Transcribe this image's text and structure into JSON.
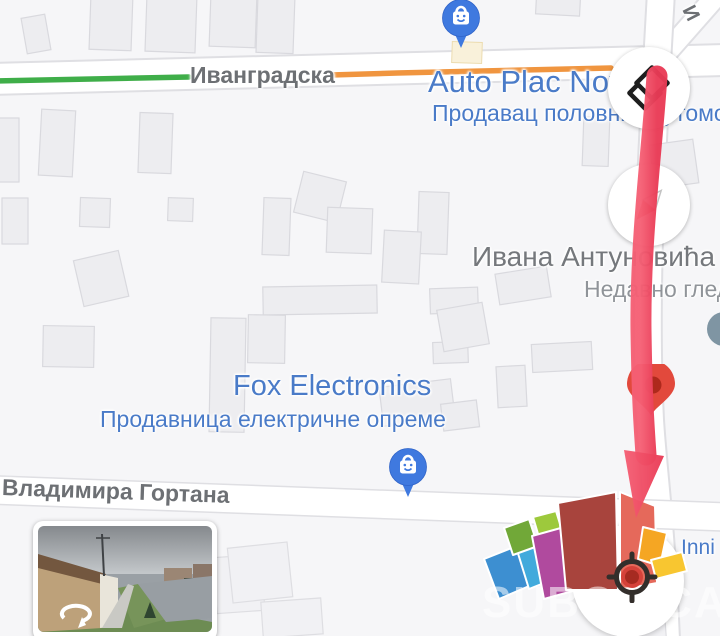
{
  "map": {
    "streets": {
      "top": "Иванградска",
      "bottom": "Владимира Гортана",
      "right": "Ивана Антуновића",
      "vertical_partial": "И"
    },
    "places": {
      "auto_plac": {
        "title": "Auto Plac Nov",
        "subtitle": "Продавац половних аутомо"
      },
      "fox": {
        "title": "Fox Electronics",
        "subtitle": "Продавница електричне опреме"
      },
      "inni": {
        "title": "Inni"
      }
    },
    "recent_label": "Недавно глед",
    "watermark": "SUBOTICA",
    "colors": {
      "background": "#f6f6f8",
      "building": "#ededf0",
      "road": "#ffffff",
      "traffic_green": "#3fae49",
      "traffic_orange": "#f0953f",
      "place_label_blue": "#4a7bc8",
      "street_label_gray": "#75787c",
      "pin_blue": "#3f79df",
      "pin_red": "#ea4335",
      "annotation_red": "#ef4560",
      "logo_segments": [
        "#3d8fd1",
        "#41aadc",
        "#71a838",
        "#9dc93c",
        "#b04a9e",
        "#a8443d",
        "#e5695b",
        "#f5a623",
        "#f8c630"
      ]
    }
  },
  "controls": {
    "layers": "layers",
    "compass": "compass",
    "locate": "locate"
  }
}
